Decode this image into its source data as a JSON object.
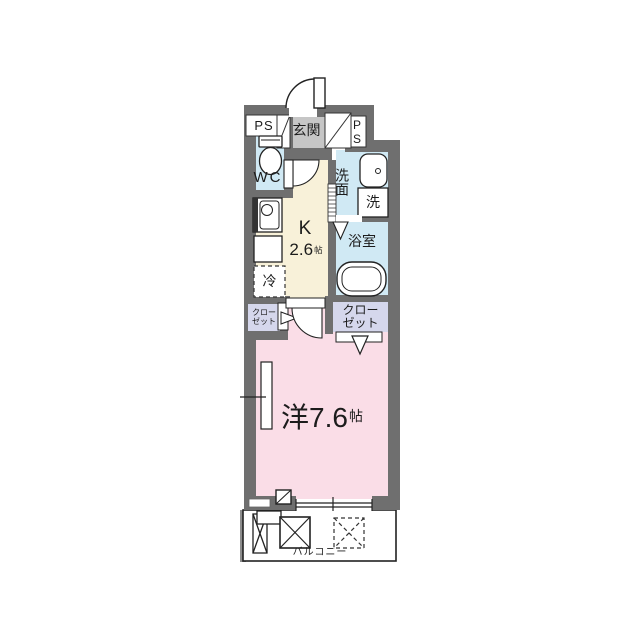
{
  "title": "ワンルーム間取り図",
  "colors": {
    "wall": "#6f6f6f",
    "entrance-floor": "#c6c6c6",
    "water-room": "#d0e9f4",
    "kitchen-floor": "#f8f1d9",
    "closet-floor": "#d5d7ec",
    "room-floor": "#fadde7",
    "line": "#1d1d1d",
    "bg": "#ffffff"
  },
  "rooms": {
    "ps_left": {
      "name": "PS"
    },
    "ps_right": {
      "name": "PS"
    },
    "entrance": {
      "name": "玄関"
    },
    "wc": {
      "name": "WC"
    },
    "washroom": {
      "name": "洗面"
    },
    "washer": {
      "name": "洗"
    },
    "bathroom": {
      "name": "浴室"
    },
    "kitchen": {
      "type": "K",
      "size": "2.6",
      "unit": "帖"
    },
    "fridge": {
      "name": "冷"
    },
    "closet_left": {
      "line1": "クロー",
      "line2": "ゼット"
    },
    "closet_right": {
      "line1": "クロー",
      "line2": "ゼット"
    },
    "main_room": {
      "type_size": "洋7.6",
      "unit": "帖"
    },
    "balcony": {
      "name": "バルコニー"
    }
  }
}
